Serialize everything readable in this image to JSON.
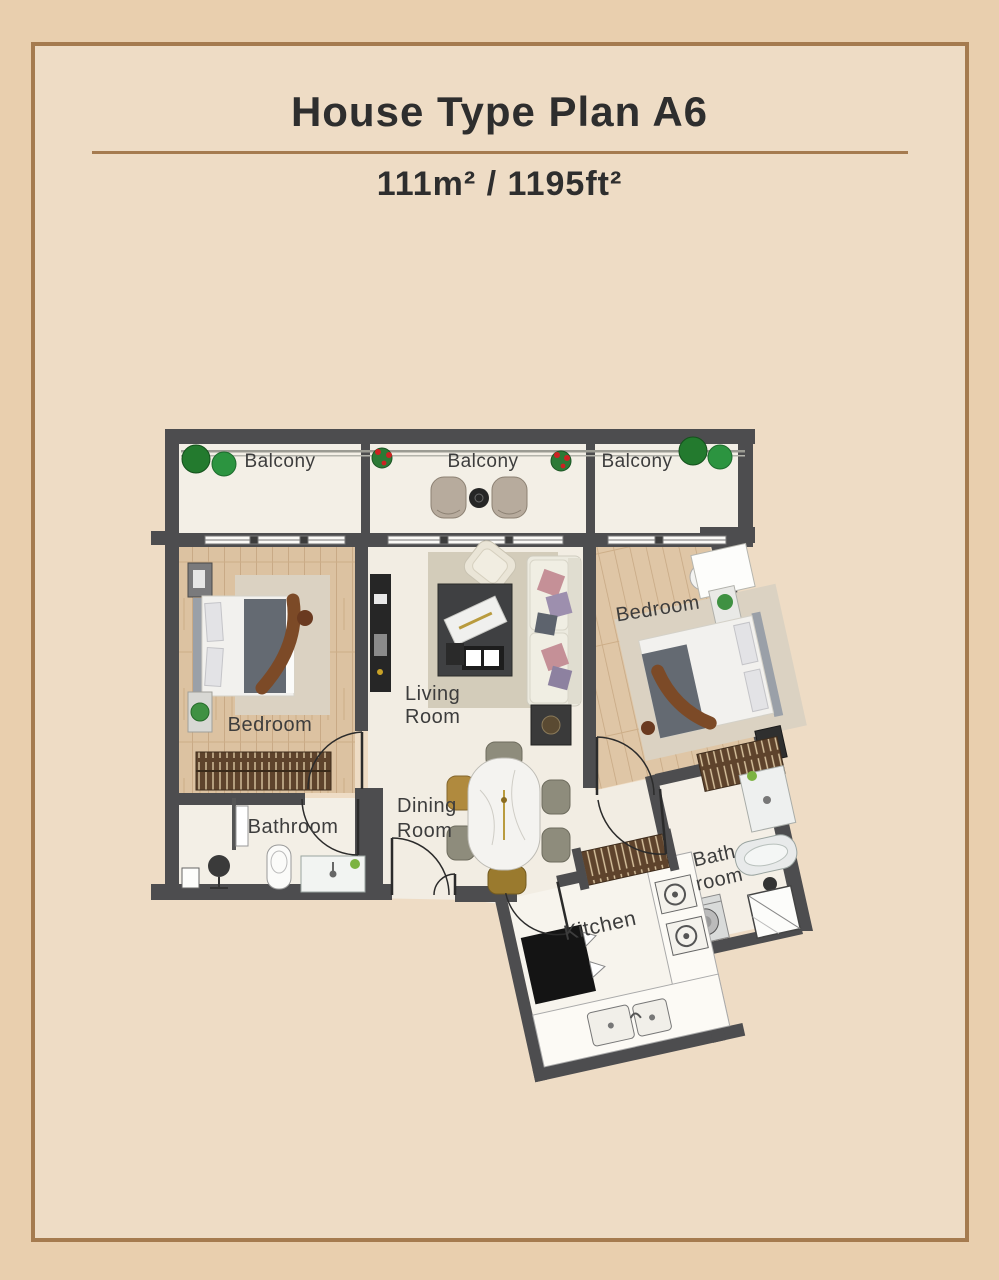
{
  "header": {
    "title": "House Type Plan A6",
    "area": "111m² / 1195ft²"
  },
  "plan": {
    "labels": {
      "balcony_left": "Balcony",
      "balcony_middle": "Balcony",
      "balcony_right": "Balcony",
      "bedroom_left": "Bedroom",
      "bedroom_right": "Bedroom",
      "living_1": "Living",
      "living_2": "Room",
      "dining_1": "Dining",
      "dining_2": "Room",
      "bathroom_left": "Bathroom",
      "bathroom_right_1": "Bath",
      "bathroom_right_2": "room",
      "kitchen": "Kitchen"
    },
    "furniture": [
      "bed",
      "wardrobe",
      "tv-console",
      "sofa",
      "armchair",
      "coffee-table",
      "side-table",
      "dining-table",
      "dining-chairs",
      "toilet",
      "vanity-sink",
      "bathtub",
      "shower",
      "washing-machine",
      "fridge",
      "stove",
      "kitchen-sink",
      "balcony-chairs",
      "plants"
    ],
    "colors": {
      "page_outer": "#e9cfae",
      "page_inner": "#eedcc5",
      "frame_line": "#a57b4f",
      "wall": "#4d4d4f",
      "wood_floor": "#dcc2a1",
      "light_floor": "#f3efe6",
      "text": "#3d3d3d",
      "plant_green": "#2c9440",
      "wardrobe_brown": "#5e432c"
    }
  }
}
